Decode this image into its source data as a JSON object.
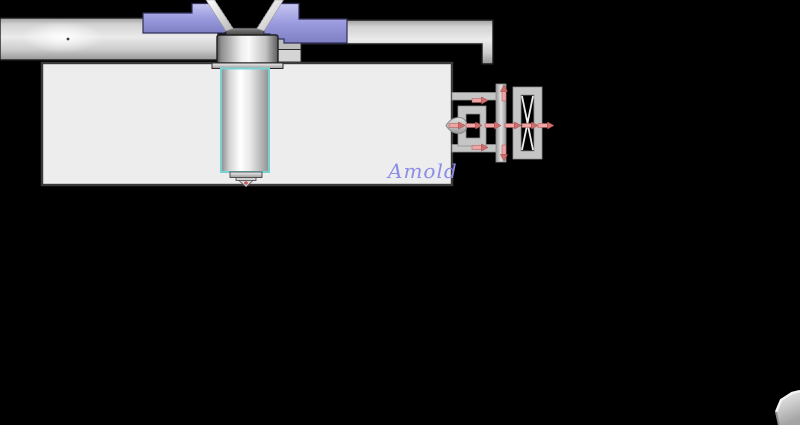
{
  "watermark": {
    "text": "Amold",
    "color": "#8c8cea"
  },
  "colors": {
    "background": "#000000",
    "purple_light": "#c6c6f2",
    "purple_mid": "#9a9ade",
    "purple_deep": "#7e7ec2",
    "teal_outline": "#7ad1d1",
    "arrow_red_light": "#eda5a5",
    "arrow_red_dark": "#d06e6e",
    "melt_dot_red": "#c85a5a",
    "block_fill": "#ededed",
    "metal_light": "#ebebeb",
    "metal_mid": "#c5c5c5",
    "outline_dark": "#3a3a3a"
  }
}
